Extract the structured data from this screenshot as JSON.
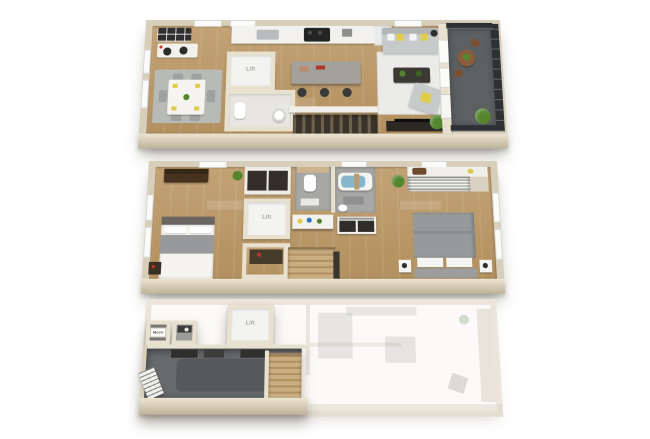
{
  "labels": {
    "lift": "Lift",
    "mech": "Mech"
  },
  "levels": [
    {
      "id": "level-3",
      "position": "top",
      "rooms": [
        "kitchen",
        "dining-area",
        "living-room",
        "powder-room",
        "lift-closet",
        "balcony"
      ],
      "furniture": [
        "range-cooktop",
        "kitchen-sink",
        "kitchen-island",
        "bar-stools",
        "dining-table-with-chairs",
        "area-rug",
        "desk-with-chairs",
        "sofa-with-pillows",
        "coffee-table",
        "accent-chair",
        "tv-console",
        "floor-lamp",
        "toilet",
        "pedestal-sink",
        "stairs",
        "bistro-set",
        "plants"
      ]
    },
    {
      "id": "level-2",
      "position": "middle",
      "rooms": [
        "bedroom-left",
        "bedroom-right",
        "toilet-room",
        "tub-room",
        "vanity-area",
        "laundry-closet",
        "lift-closet",
        "closets"
      ],
      "furniture": [
        "bed-white-duvet",
        "bed-gray-duvet",
        "loveseat",
        "wardrobes",
        "dresser",
        "nightstands",
        "toilet",
        "bathtub",
        "vanity-counter",
        "washer-dryer",
        "stairs",
        "plants"
      ]
    },
    {
      "id": "level-1",
      "position": "bottom",
      "faded": true,
      "rooms": [
        "garage",
        "mech-room",
        "utility-room",
        "lift-closet"
      ],
      "furniture": [
        "garage-door",
        "storage-items",
        "stairs",
        "utility-sink"
      ]
    }
  ],
  "colors": {
    "wall": "#d8cfbb",
    "wallLight": "#ece4d2",
    "wallDark": "#bfb49a",
    "innerWall": "#e9e1cf",
    "wood": "#c3a276",
    "woodDark": "#b2905f",
    "tileGray": "#a7a7a5",
    "tileWhite": "#e8e6e2",
    "fixture": "#f5f4f1",
    "counter": "#f2f1ed",
    "island": "#a3a19b",
    "dark": "#2f2c27",
    "sofa": "#c7cacb",
    "yellow": "#e0cc49",
    "plant": "#55862f",
    "plantDark": "#3c6420",
    "deck": "#5d6062",
    "railing": "#2e3133",
    "water": "#84b7cd",
    "stairsWood": "#c9ae83",
    "stairsDark": "#453c31",
    "garage": "#67696b",
    "duvet": "#97999b",
    "headboard": "#6b6661",
    "bench": "#46321f",
    "rugGray": "#b8bab8",
    "rugWhite": "#ebebe9",
    "ghost": "#efece6"
  }
}
